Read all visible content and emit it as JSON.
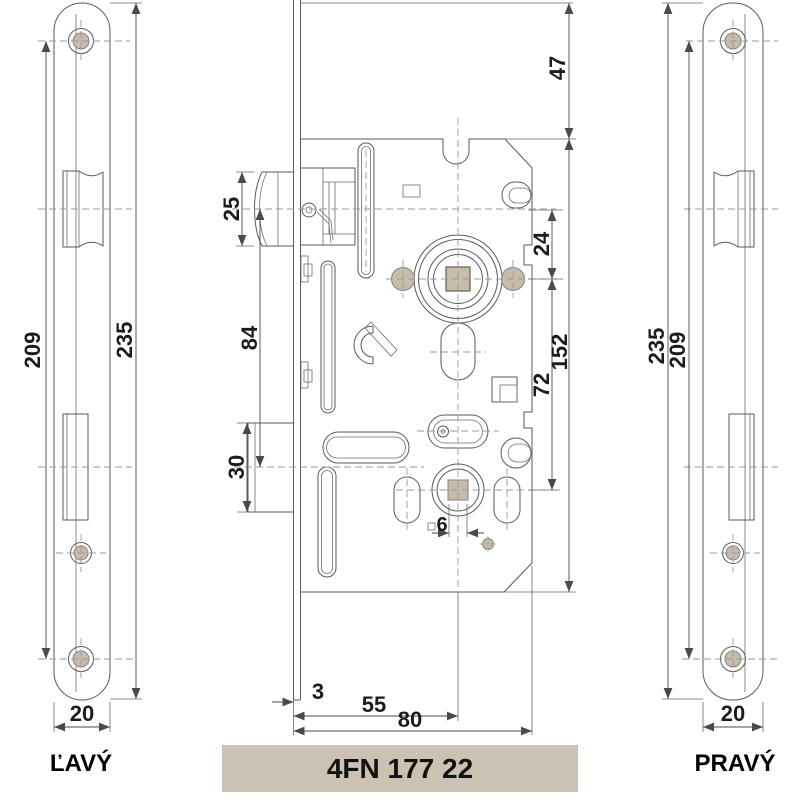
{
  "product": {
    "code": "4FN 177 22"
  },
  "views": {
    "left": {
      "label": "ĽAVÝ",
      "dims": {
        "plate_length": "235",
        "screw_spacing": "209",
        "plate_width": "20"
      }
    },
    "right": {
      "label": "PRAVÝ",
      "dims": {
        "plate_length": "235",
        "screw_spacing": "209",
        "plate_width": "20"
      }
    },
    "center": {
      "dims": {
        "faceplate_top_to_body": "47",
        "latch_height": "25",
        "latch_axis_to_hub_axis": "24",
        "latch_axis_to_bolt_axis": "84",
        "hub_to_lower_hub": "72",
        "body_height": "152",
        "bolt_height": "30",
        "lower_square": "6",
        "plate_thickness": "3",
        "backset": "55",
        "body_depth": "80"
      }
    }
  },
  "colors": {
    "accent_tan": "#C6BCAB",
    "label_bg": "#CBC2B3"
  }
}
